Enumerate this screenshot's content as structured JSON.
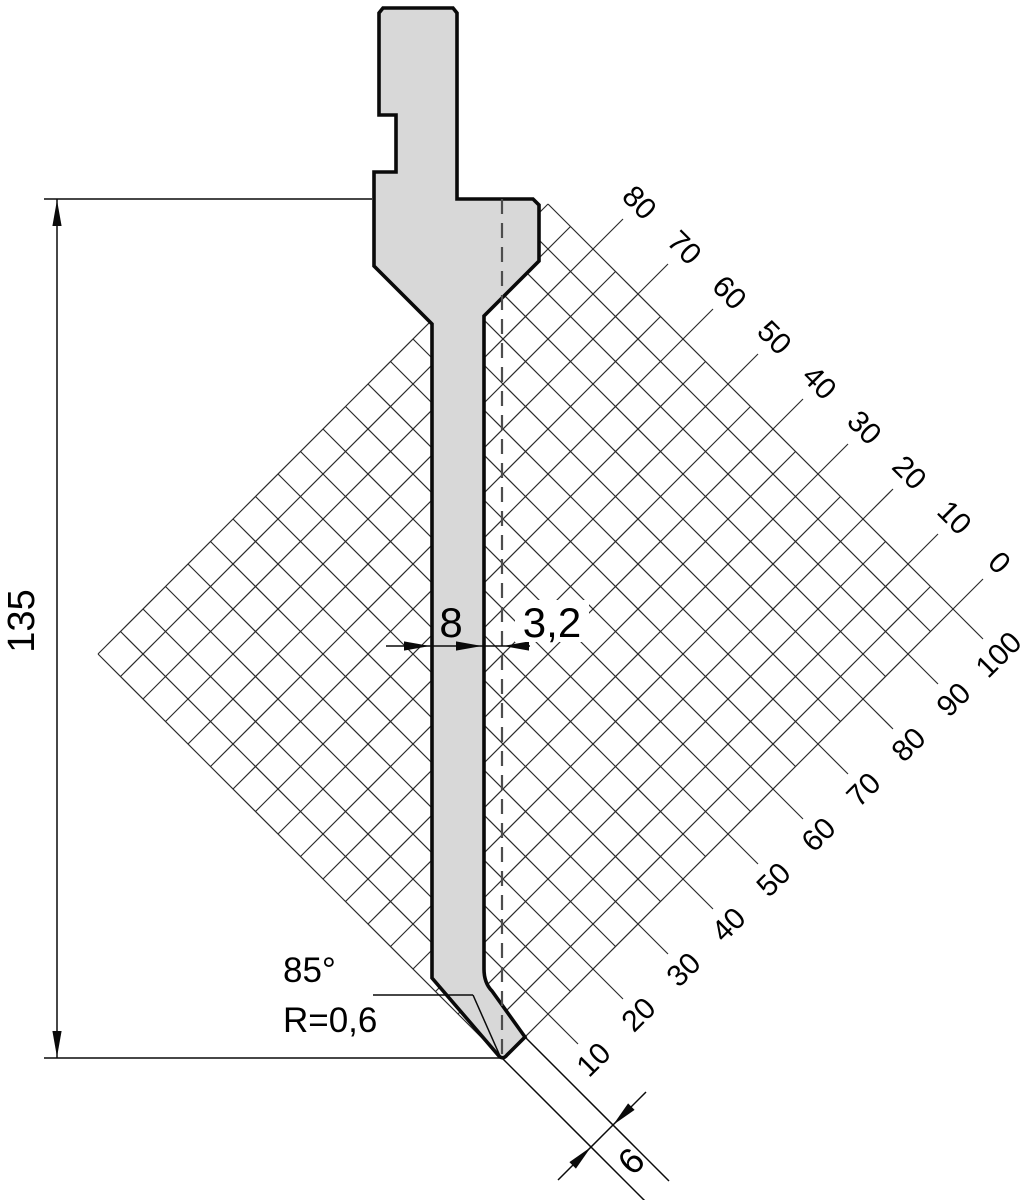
{
  "drawing": {
    "dimensions": {
      "height": "135",
      "blade_width": "8",
      "tip_offset": "3,2",
      "tip_angle": "85°",
      "tip_radius": "R=0,6",
      "bottom_width": "6"
    },
    "scale_upper": [
      "80",
      "70",
      "60",
      "50",
      "40",
      "30",
      "20",
      "10",
      "0"
    ],
    "scale_lower": [
      "10",
      "20",
      "30",
      "40",
      "50",
      "60",
      "70",
      "80",
      "90",
      "100"
    ],
    "colors": {
      "punch_fill": "#d8d8d8",
      "line": "#0a0a0a",
      "grid_line": "#2b2b2b"
    }
  }
}
